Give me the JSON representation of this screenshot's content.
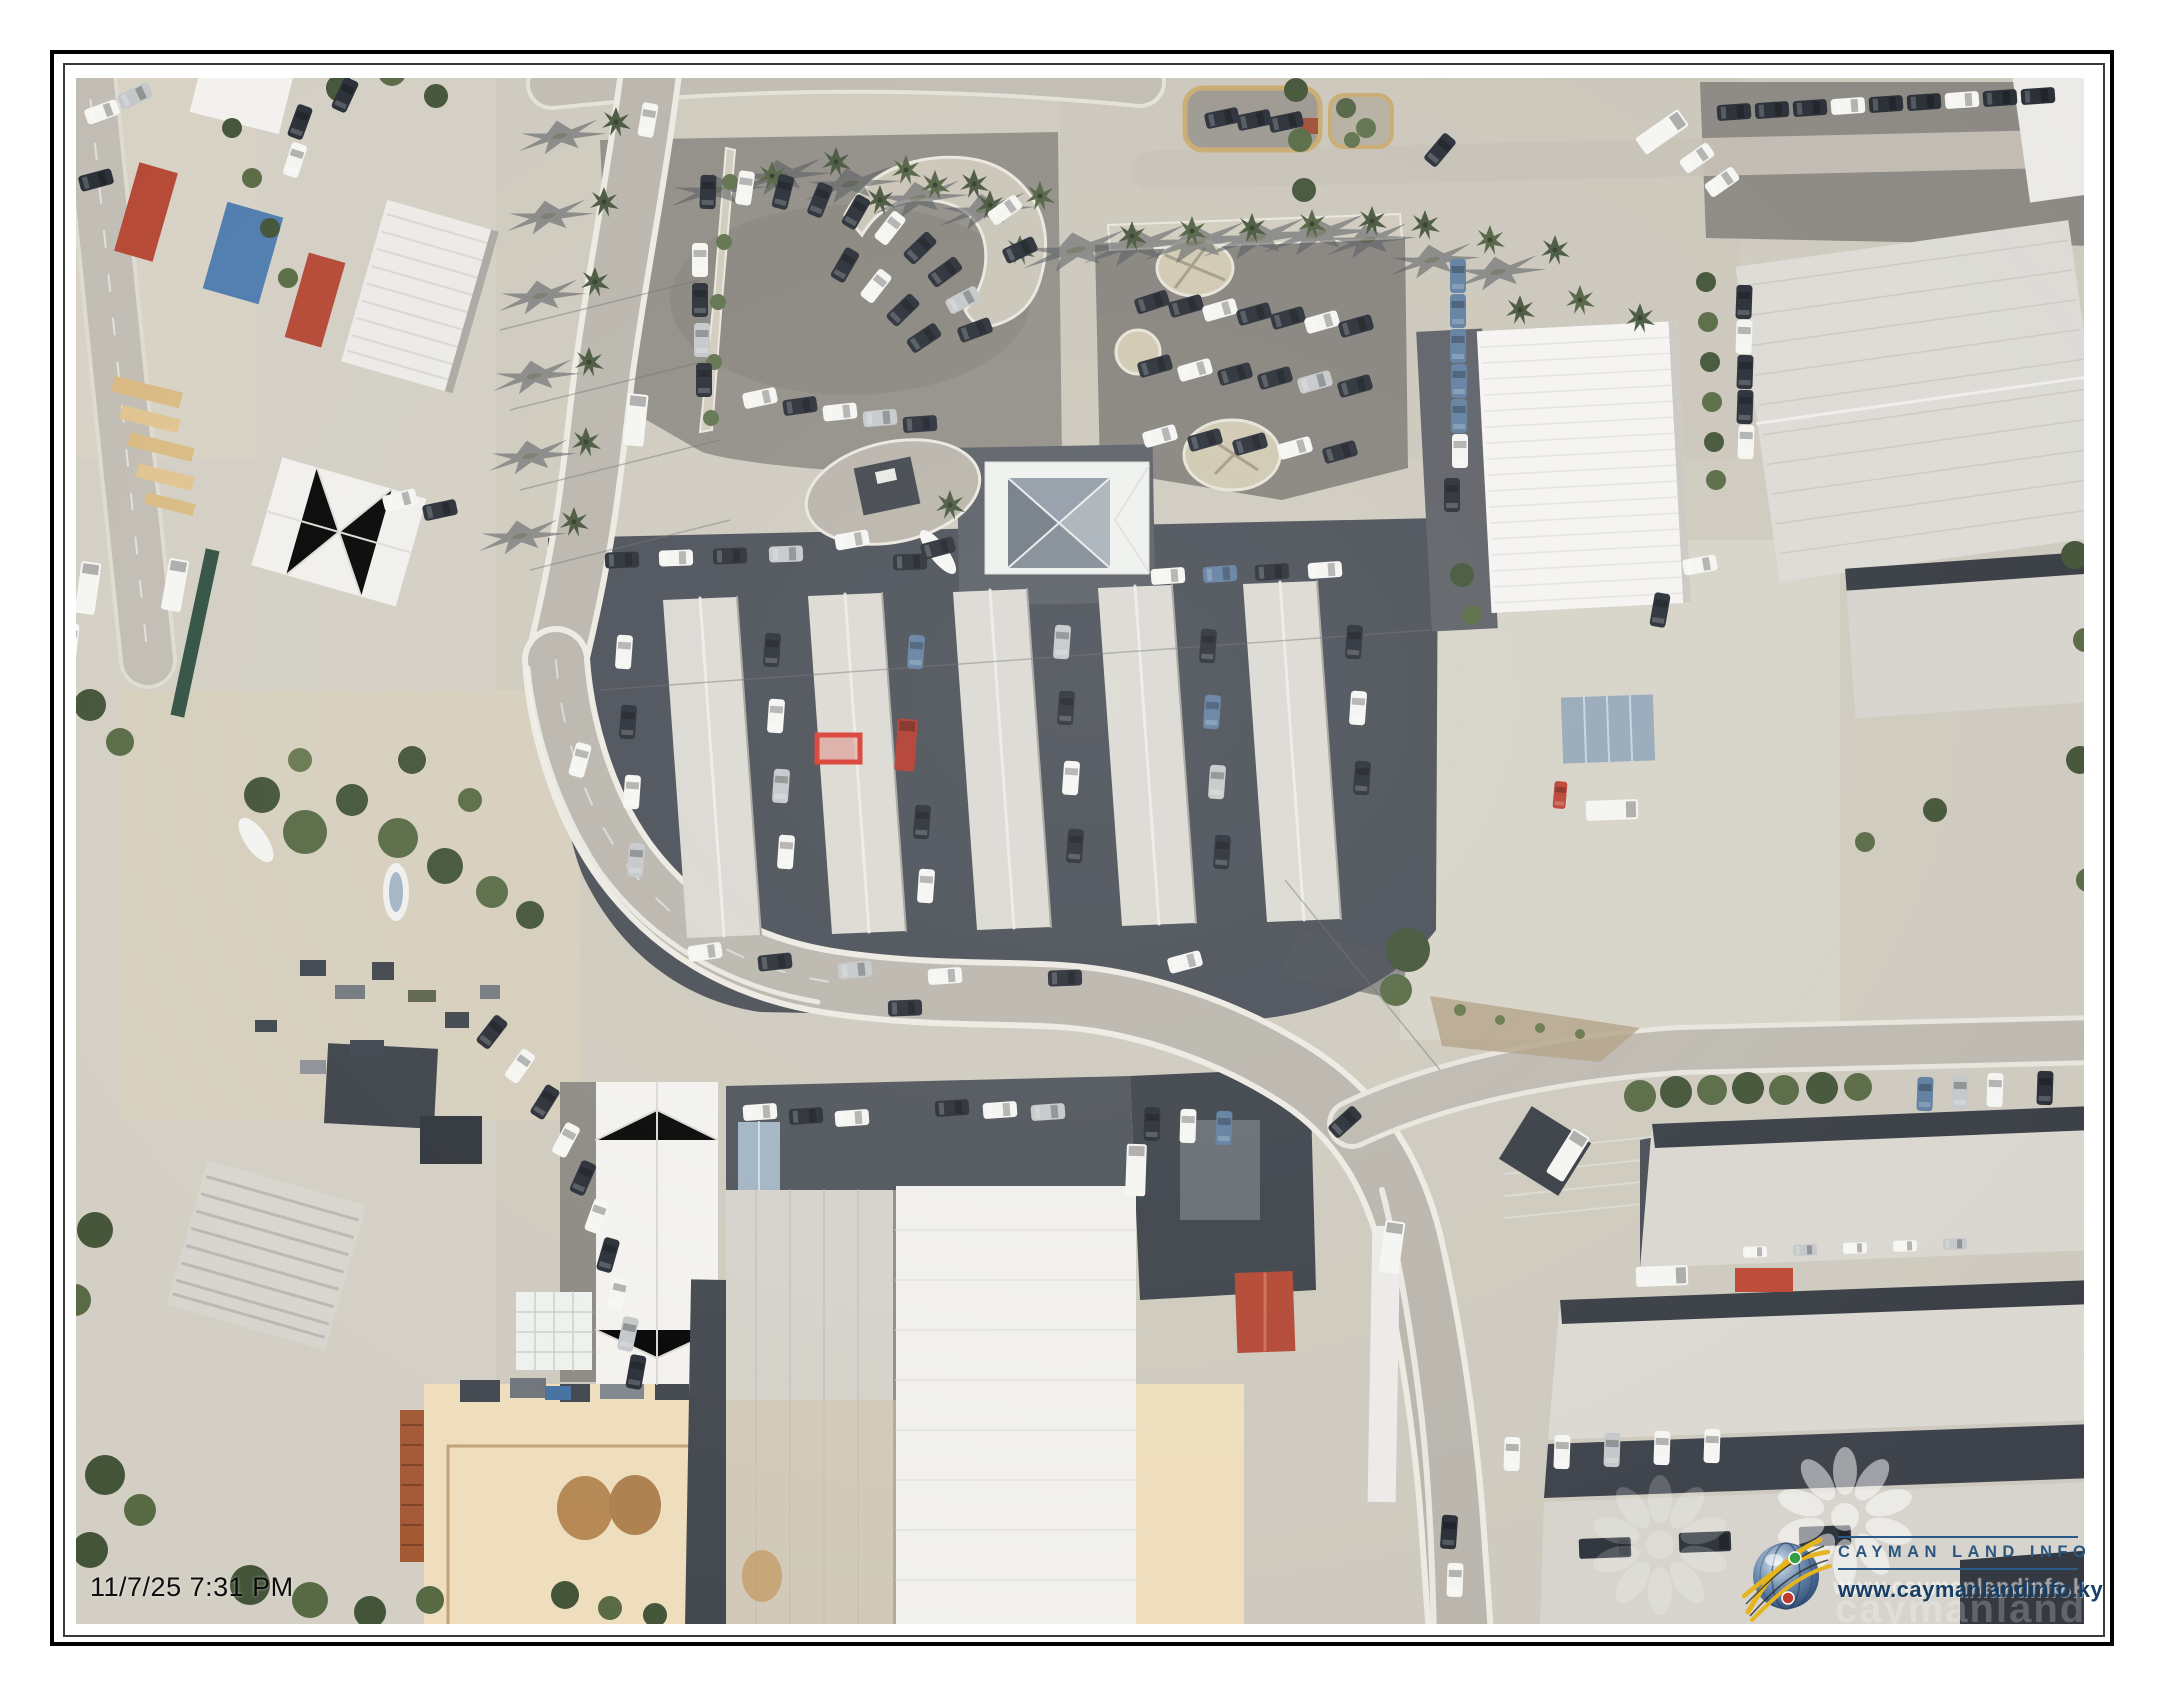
{
  "page": {
    "timestamp": "11/7/25 7:31 PM"
  },
  "logo": {
    "title": "CAYMAN LAND INFO",
    "url": "www.caymanlandinfo.ky",
    "accent_color": "#2b5880",
    "url_color": "#173f66",
    "globe_icon": "globe-with-yellow-orbits"
  },
  "map": {
    "type": "aerial-imagery",
    "highlight": {
      "label": "selected-parcel",
      "color": "#df362b"
    },
    "watermark": "white-flower-starburst"
  }
}
